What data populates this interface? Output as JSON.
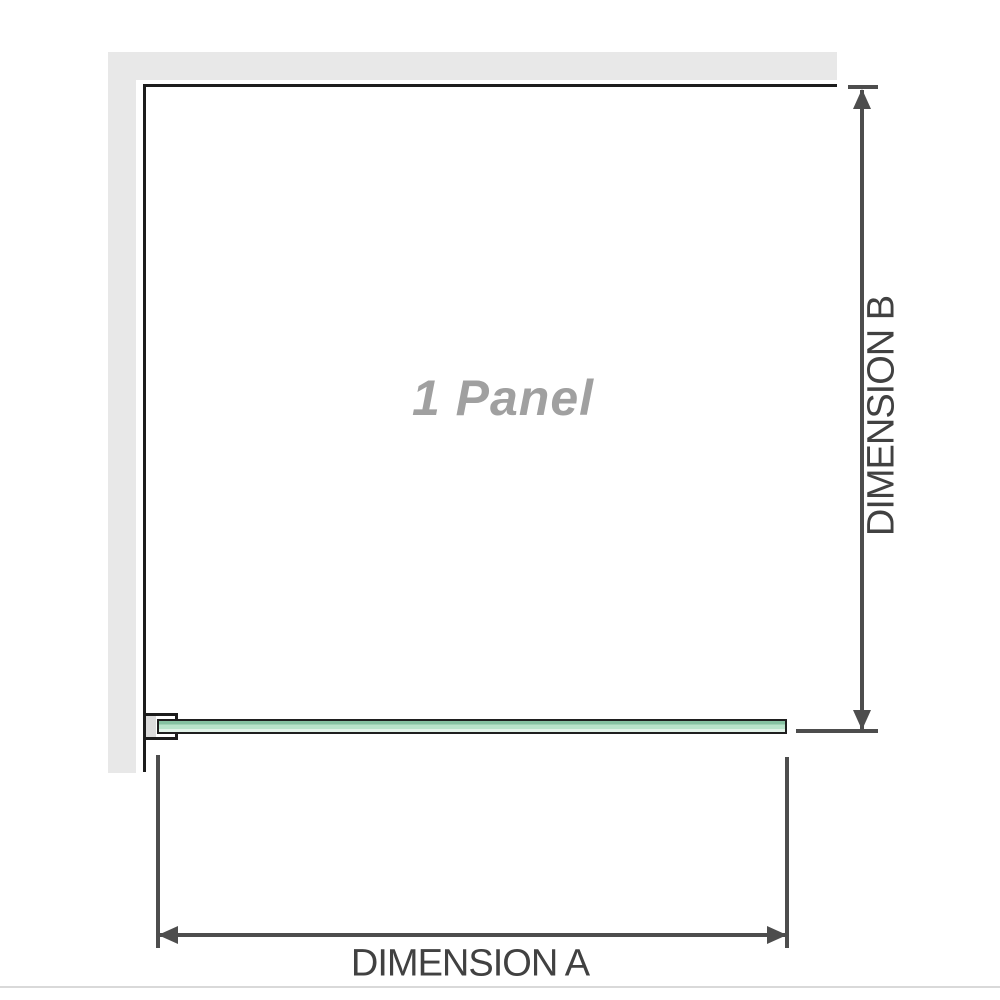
{
  "diagram": {
    "title": "1 Panel",
    "dimensions": {
      "a_label": "DIMENSION A",
      "b_label": "DIMENSION B"
    },
    "icons": {
      "arrows": [
        "arrow-up",
        "arrow-down",
        "arrow-left",
        "arrow-right"
      ]
    },
    "colors": {
      "wall": "#e8e8e8",
      "outline": "#1c1c1c",
      "glass_dark": "#86c2a2",
      "glass_light": "#b9e4cb",
      "glass_pale": "#e2f3e9",
      "bracket_fill": "#dcdcdc",
      "dim": "#4d4d4d",
      "label": "#414141",
      "panel_text": "#a0a0a0",
      "bottom_rule": "#d9d9d9"
    }
  }
}
